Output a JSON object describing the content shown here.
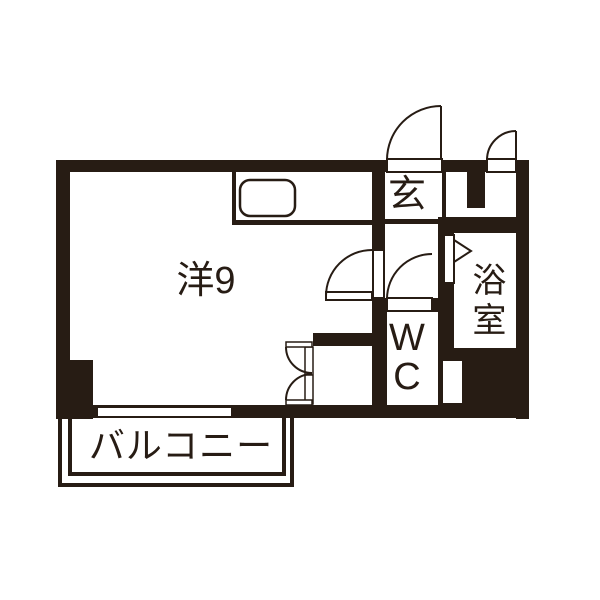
{
  "plan": {
    "ink_color": "#271c14",
    "labels": {
      "living": "洋9",
      "entrance": "玄",
      "wc": "WC",
      "bath": "浴室",
      "balcony": "バルコニー"
    }
  }
}
